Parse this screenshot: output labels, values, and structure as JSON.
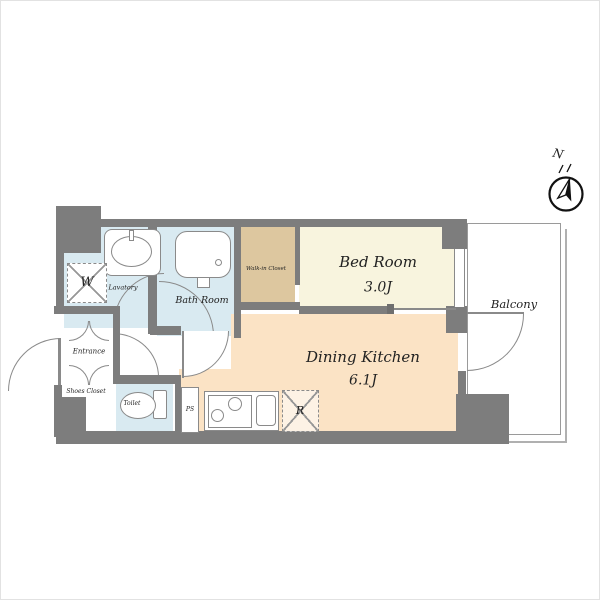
{
  "compass": {
    "label": "N"
  },
  "rooms": {
    "bedroom": {
      "name": "Bed Room",
      "area": "3.0J"
    },
    "dining_kitchen": {
      "name": "Dining Kitchen",
      "area": "6.1J"
    },
    "bathroom": {
      "name": "Bath Room"
    },
    "lavatory": {
      "name": "Lavatory"
    },
    "walk_in_closet": {
      "name": "Walk-in Closet"
    },
    "entrance": {
      "name": "Entrance"
    },
    "shoes_closet": {
      "name": "Shoes Closet"
    },
    "toilet": {
      "name": "Toilet"
    },
    "balcony": {
      "name": "Balcony"
    }
  },
  "fixtures": {
    "washer_space": {
      "label": "W"
    },
    "refrigerator_space": {
      "label": "R"
    },
    "pipe_space": {
      "label": "PS"
    }
  },
  "colors": {
    "wall_gray": "#7d7d7d",
    "wet_area_blue": "#d9eaf1",
    "closet_tan": "#ddc79f",
    "bedroom_cream": "#f8f4de",
    "dining_kitchen_peach": "#fbe3c5",
    "balcony_outline": "#9a9a9a"
  }
}
